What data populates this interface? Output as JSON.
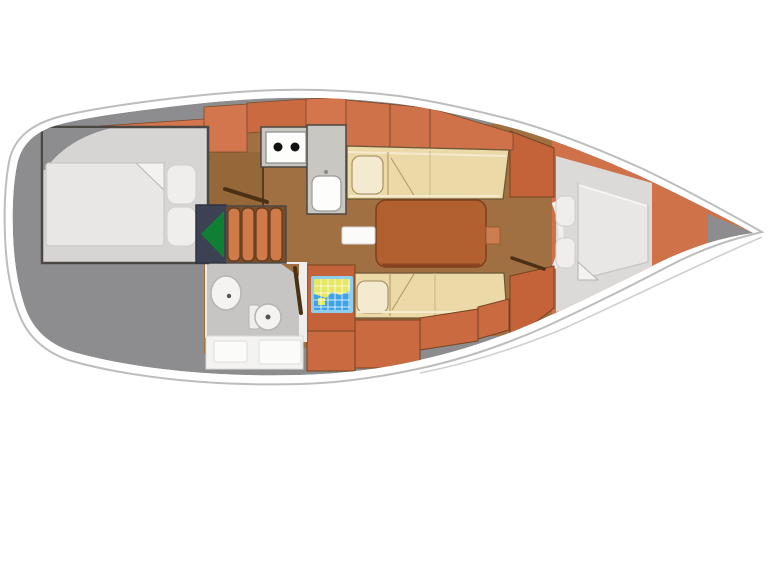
{
  "figure": {
    "type": "sailboat-interior-floor-plan",
    "orientation": "bow-right",
    "rooms": [
      {
        "name": "stern-deck"
      },
      {
        "name": "aft-cabin"
      },
      {
        "name": "galley"
      },
      {
        "name": "companionway"
      },
      {
        "name": "head-bathroom"
      },
      {
        "name": "saloon"
      },
      {
        "name": "chart-table"
      },
      {
        "name": "v-berth"
      },
      {
        "name": "bow-locker"
      }
    ]
  },
  "colors": {
    "page_bg": "#ffffff",
    "hull_fill": "#ffffff",
    "hull_stroke": "#bdbdbd",
    "deck_gray": "#8d8d8f",
    "tip_gray": "#8d8d8f",
    "floor_brown": "#a06f42",
    "cabinet_brown": "#966739",
    "orange": "#cf7149",
    "orange_dark": "#c4633a",
    "orange_mid": "#c96a41",
    "orange_light": "#d3764e",
    "step_orange": "#cf7a48",
    "step_bg": "#7a4c28",
    "cream": "#ecd9a8",
    "cream_light": "#f4ead0",
    "cabin_floor": "#d6d5d3",
    "vberth_floor": "#dbdad8",
    "head_floor": "#c6c5c3",
    "bed": "#e8e7e5",
    "bed_fold": "#f3f2f1",
    "pillow": "#efeeec",
    "counter_gray": "#c8c7c2",
    "appliance_white": "#fdfdfc",
    "cabinet_white": "#f4f3f1",
    "panel_white": "#fbfbf9",
    "navy": "#3c4153",
    "green": "#0f7f33",
    "map_frame": "#8ecfee",
    "map_blue": "#3fa3e6",
    "map_yellow": "#e6e762",
    "table_brown": "#b2602f",
    "table_tab": "#cd7e50",
    "door_brown": "#4a3015",
    "wall_light": "#eeeeec",
    "burner_black": "#111111"
  }
}
